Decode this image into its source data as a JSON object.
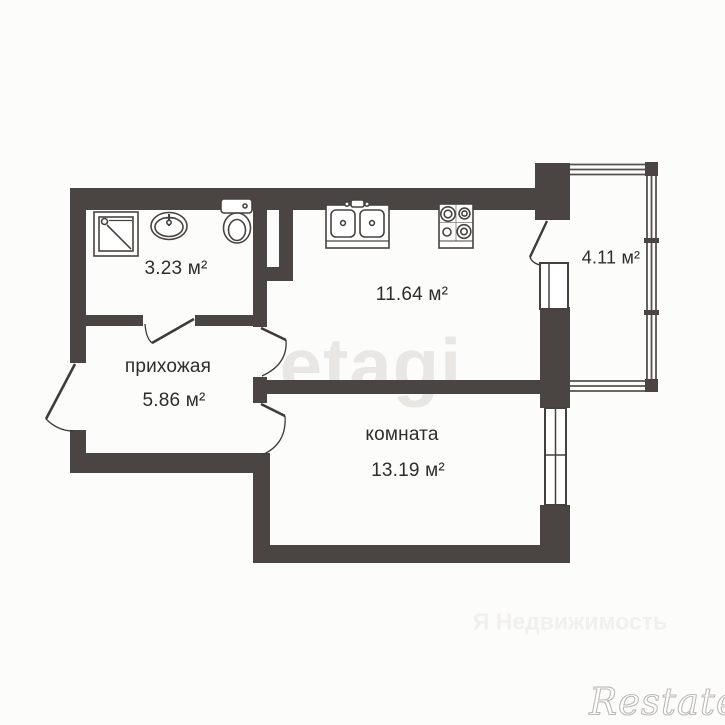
{
  "title": "apartment-floor-plan",
  "colors": {
    "wall": "#4a4542",
    "line": "#3e3b38",
    "text": "#2f2d2b",
    "background": "#fcfcfb",
    "watermark_light": "#e9e7e4"
  },
  "rooms": {
    "bathroom": {
      "area": "3.23 м²"
    },
    "hallway": {
      "name": "прихожая",
      "area": "5.86 м²"
    },
    "kitchen": {
      "area": "11.64 м²"
    },
    "balcony": {
      "area": "4.11 м²"
    },
    "living_room": {
      "name": "комната",
      "area": "13.19 м²"
    }
  },
  "watermarks": {
    "center": "etagi",
    "bottom": "Я Недвижимость",
    "corner": "Restate"
  }
}
